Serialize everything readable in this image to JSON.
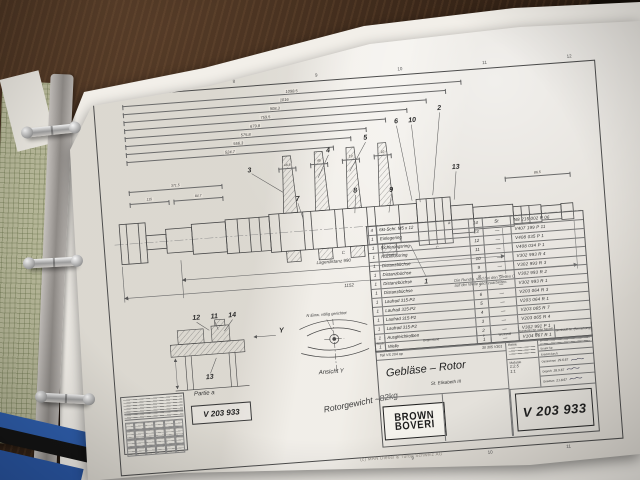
{
  "scene": {
    "copyright": "(c) MAN Diesel & Turbo Schweiz AG"
  },
  "frame": {
    "top_numbers": [
      "8",
      "9",
      "10",
      "11",
      "12"
    ],
    "bottom_numbers": [
      "9",
      "10",
      "11"
    ]
  },
  "drawing": {
    "dims_top": [
      "1098.5",
      "1016",
      "908.3",
      "759.5",
      "679.8",
      "575.8",
      "556.3",
      "524.7"
    ],
    "dims_left": [
      "371.5",
      "115",
      "84.7"
    ],
    "dims_small": [
      "48.8",
      "45",
      "19",
      "10"
    ],
    "dim_lager": "Lagerdistanz  990",
    "dim_total": "1152",
    "dim_right": "86.5",
    "callouts_main": [
      "3",
      "4",
      "5",
      "6",
      "10",
      "2",
      "7",
      "8",
      "9",
      "13",
      "1"
    ],
    "callouts_detail": [
      "12",
      "11",
      "14",
      "13"
    ],
    "label_y_arrow": "Y",
    "label_partie": "Partie a",
    "label_ansicht": "Ansicht Y",
    "label_a": "a",
    "label_c": "C",
    "note_c_line1": "Die Rundla. sind bei den Stellen  C",
    "note_c_line2": "auf der Welle nachzuarbeiten.",
    "note_n": "N Einw. völlig gerichtet",
    "weight_note": "Rotorgewicht ~82kg"
  },
  "parts_table": {
    "rows": [
      {
        "qty": "4",
        "name": "6kt-Schr.  M5 x 12",
        "pos": "14",
        "mat": "St",
        "part": "N8 215 002 P 06"
      },
      {
        "qty": "1",
        "name": "Einlegering",
        "pos": "13",
        "mat": "—",
        "part": "V407 199 P 11"
      },
      {
        "qty": "1",
        "name": "Sicherungsring",
        "pos": "12",
        "mat": "—",
        "part": "V408 035 P 1"
      },
      {
        "qty": "1",
        "name": "Rückflussring",
        "pos": "11",
        "mat": "—",
        "part": "V408 034 P 1"
      },
      {
        "qty": "1",
        "name": "Distanzbüchse",
        "pos": "10",
        "mat": "—",
        "part": "V302 993 R 4"
      },
      {
        "qty": "1",
        "name": "Distanzbüchse",
        "pos": "9",
        "mat": "—",
        "part": "V302 993 R 3"
      },
      {
        "qty": "1",
        "name": "Distanzbüchse",
        "pos": "8",
        "mat": "—",
        "part": "V302 993 R 2"
      },
      {
        "qty": "1",
        "name": "Distanzbüchse",
        "pos": "7",
        "mat": "—",
        "part": "V302 993 R 1"
      },
      {
        "qty": "1",
        "name": "Laufrad 315-P2",
        "pos": "6",
        "mat": "—",
        "part": "V203 064 R 3"
      },
      {
        "qty": "1",
        "name": "Laufrad 315-P2",
        "pos": "5",
        "mat": "—",
        "part": "V203 064 R 1"
      },
      {
        "qty": "1",
        "name": "Laufrad 315-P2",
        "pos": "4",
        "mat": "—",
        "part": "V203 065 R 7"
      },
      {
        "qty": "1",
        "name": "Laufrad 315-P2",
        "pos": "3",
        "mat": "—",
        "part": "V203 065 R 4"
      },
      {
        "qty": "1",
        "name": "Ausgleichkolben",
        "pos": "2",
        "mat": "—",
        "part": "V302 991 P 1"
      },
      {
        "qty": "1",
        "name": "Welle",
        "pos": "1",
        "mat": "—",
        "part": "V104 667 R 1"
      }
    ],
    "footer": {
      "stueck": "Stück",
      "gegenstand": "Gegenstand",
      "p": "P",
      "werkstoff": "Werkstoff",
      "modell": "Gewichts-Nr. oder Modell-Nr.",
      "bemerkung": "Werkstoff-Nr. (Bemerkung)"
    }
  },
  "title_block": {
    "ref_left": "Teil  VS 204 op",
    "ref_right": "30 305 V301",
    "title": "Gebläse – Rotor",
    "subtitle": "St. Elisabeth III",
    "brand_line1": "BROWN",
    "brand_line2": "BOVERI",
    "keine": "Keine",
    "massstab_label": "Maßstab",
    "massstab_1": "1:2.5",
    "massstab_2": "1:1",
    "ersatz_fuer": "Ersatz für:",
    "ersetzt_durch": "Ersetzt durch:",
    "gezeichnet_label": "Gezeichnet",
    "gezeichnet_date": "29.6.67",
    "geprueft_label": "Geprüft",
    "geprueft_date": "28.9.67",
    "gesehen_label": "Gesehen",
    "gesehen_date": "21.8.67",
    "drawing_number": "V 203 933"
  },
  "legend": {
    "number": "V 203 933"
  }
}
